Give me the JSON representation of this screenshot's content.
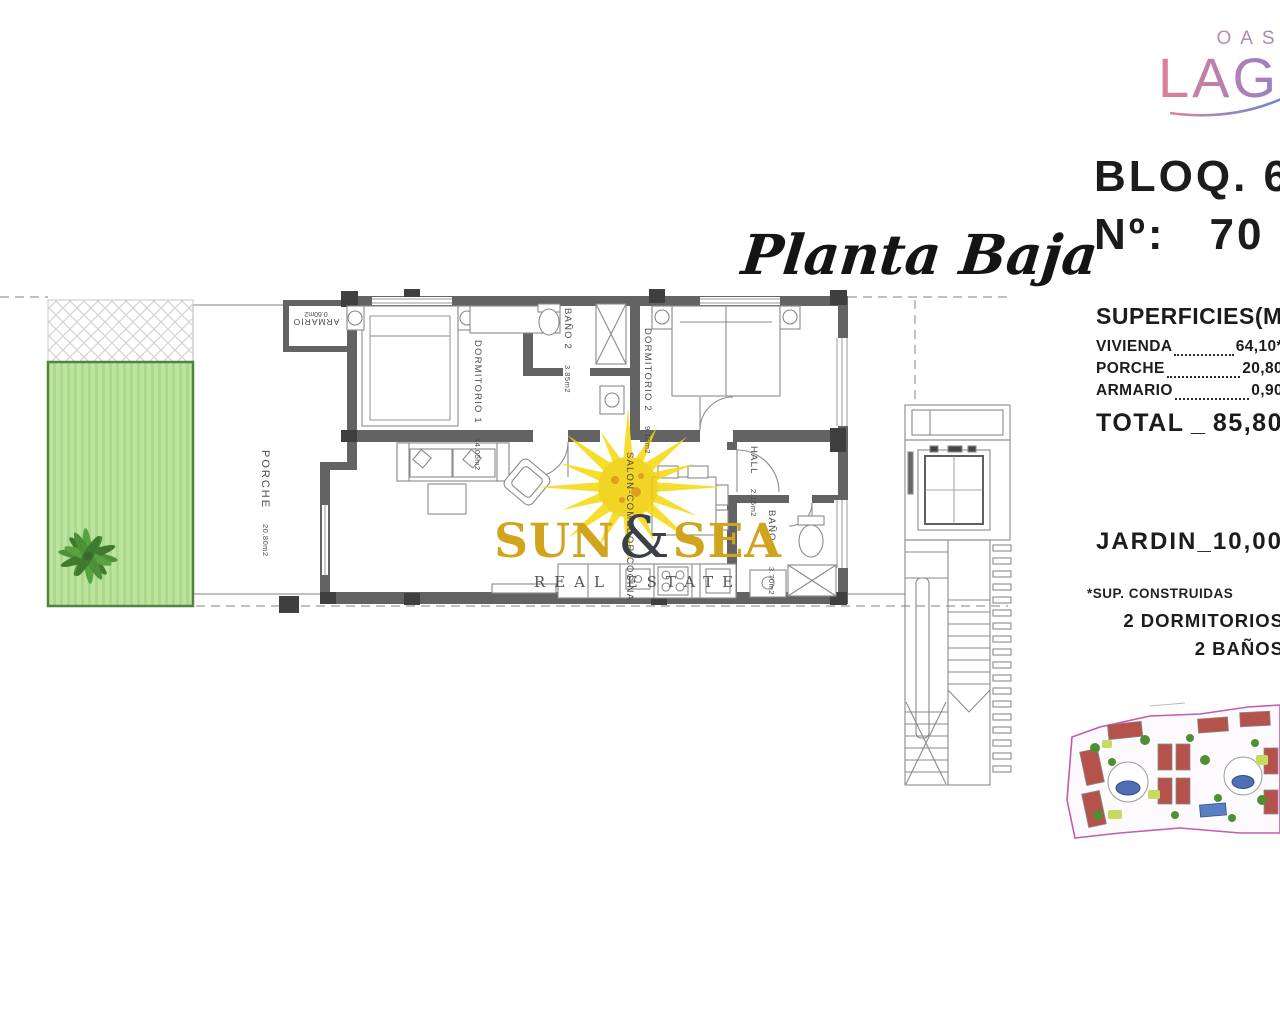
{
  "brand": {
    "oasis": "OASIS",
    "laguna": "LAGUNA"
  },
  "plan_title": "Planta Baja",
  "unit": {
    "block": "BLOQ. 6",
    "number_label": "Nº:",
    "number_value": "70"
  },
  "surfaces": {
    "title": "SUPERFICIES(M2)",
    "rows": [
      {
        "label": "VIVIENDA",
        "value": "64,10*"
      },
      {
        "label": "PORCHE",
        "value": "20,80"
      },
      {
        "label": "ARMARIO",
        "value": "0,90"
      }
    ],
    "total_label": "TOTAL",
    "total_sep": "_",
    "total_value": "85,80",
    "jardin_label": "JARDIN",
    "jardin_sep": "_",
    "jardin_value": "10,00",
    "footnote": "*SUP. CONSTRUIDAS",
    "features": [
      "2 DORMITORIOS",
      "2 BAÑOS"
    ]
  },
  "rooms": {
    "dormitorio1": {
      "label": "DORMITORIO 1",
      "area": "14.05m2"
    },
    "bano2": {
      "label": "BAÑO 2",
      "area": "3.85m2"
    },
    "dormitorio2": {
      "label": "DORMITORIO 2",
      "area": "9.10m2"
    },
    "hall": {
      "label": "HALL",
      "area": "2.15m2"
    },
    "bano1": {
      "label": "BAÑO 1",
      "area": "3.70m2"
    },
    "salon": {
      "label": "SALON-COMEDOR-COCINA",
      "area": ""
    },
    "porche": {
      "label": "PORCHE",
      "area": "20.80m2"
    },
    "armario": {
      "label": "ARMARIO",
      "area": "0.60m2"
    }
  },
  "watermark": {
    "word1": "SUN",
    "amp": "&",
    "word2": "SEA",
    "tagline": "REAL ESTATE"
  },
  "colors": {
    "wall_gray": "#636363",
    "pillar_gray": "#3f3f3f",
    "garden_green": "#b8e29b",
    "garden_border": "#55833f",
    "sun_yellow": "#f5d90a",
    "brand_gold": "#d0a41c",
    "siteplan_pink": "#c25bb4",
    "pool_blue": "#4f6fb5"
  }
}
